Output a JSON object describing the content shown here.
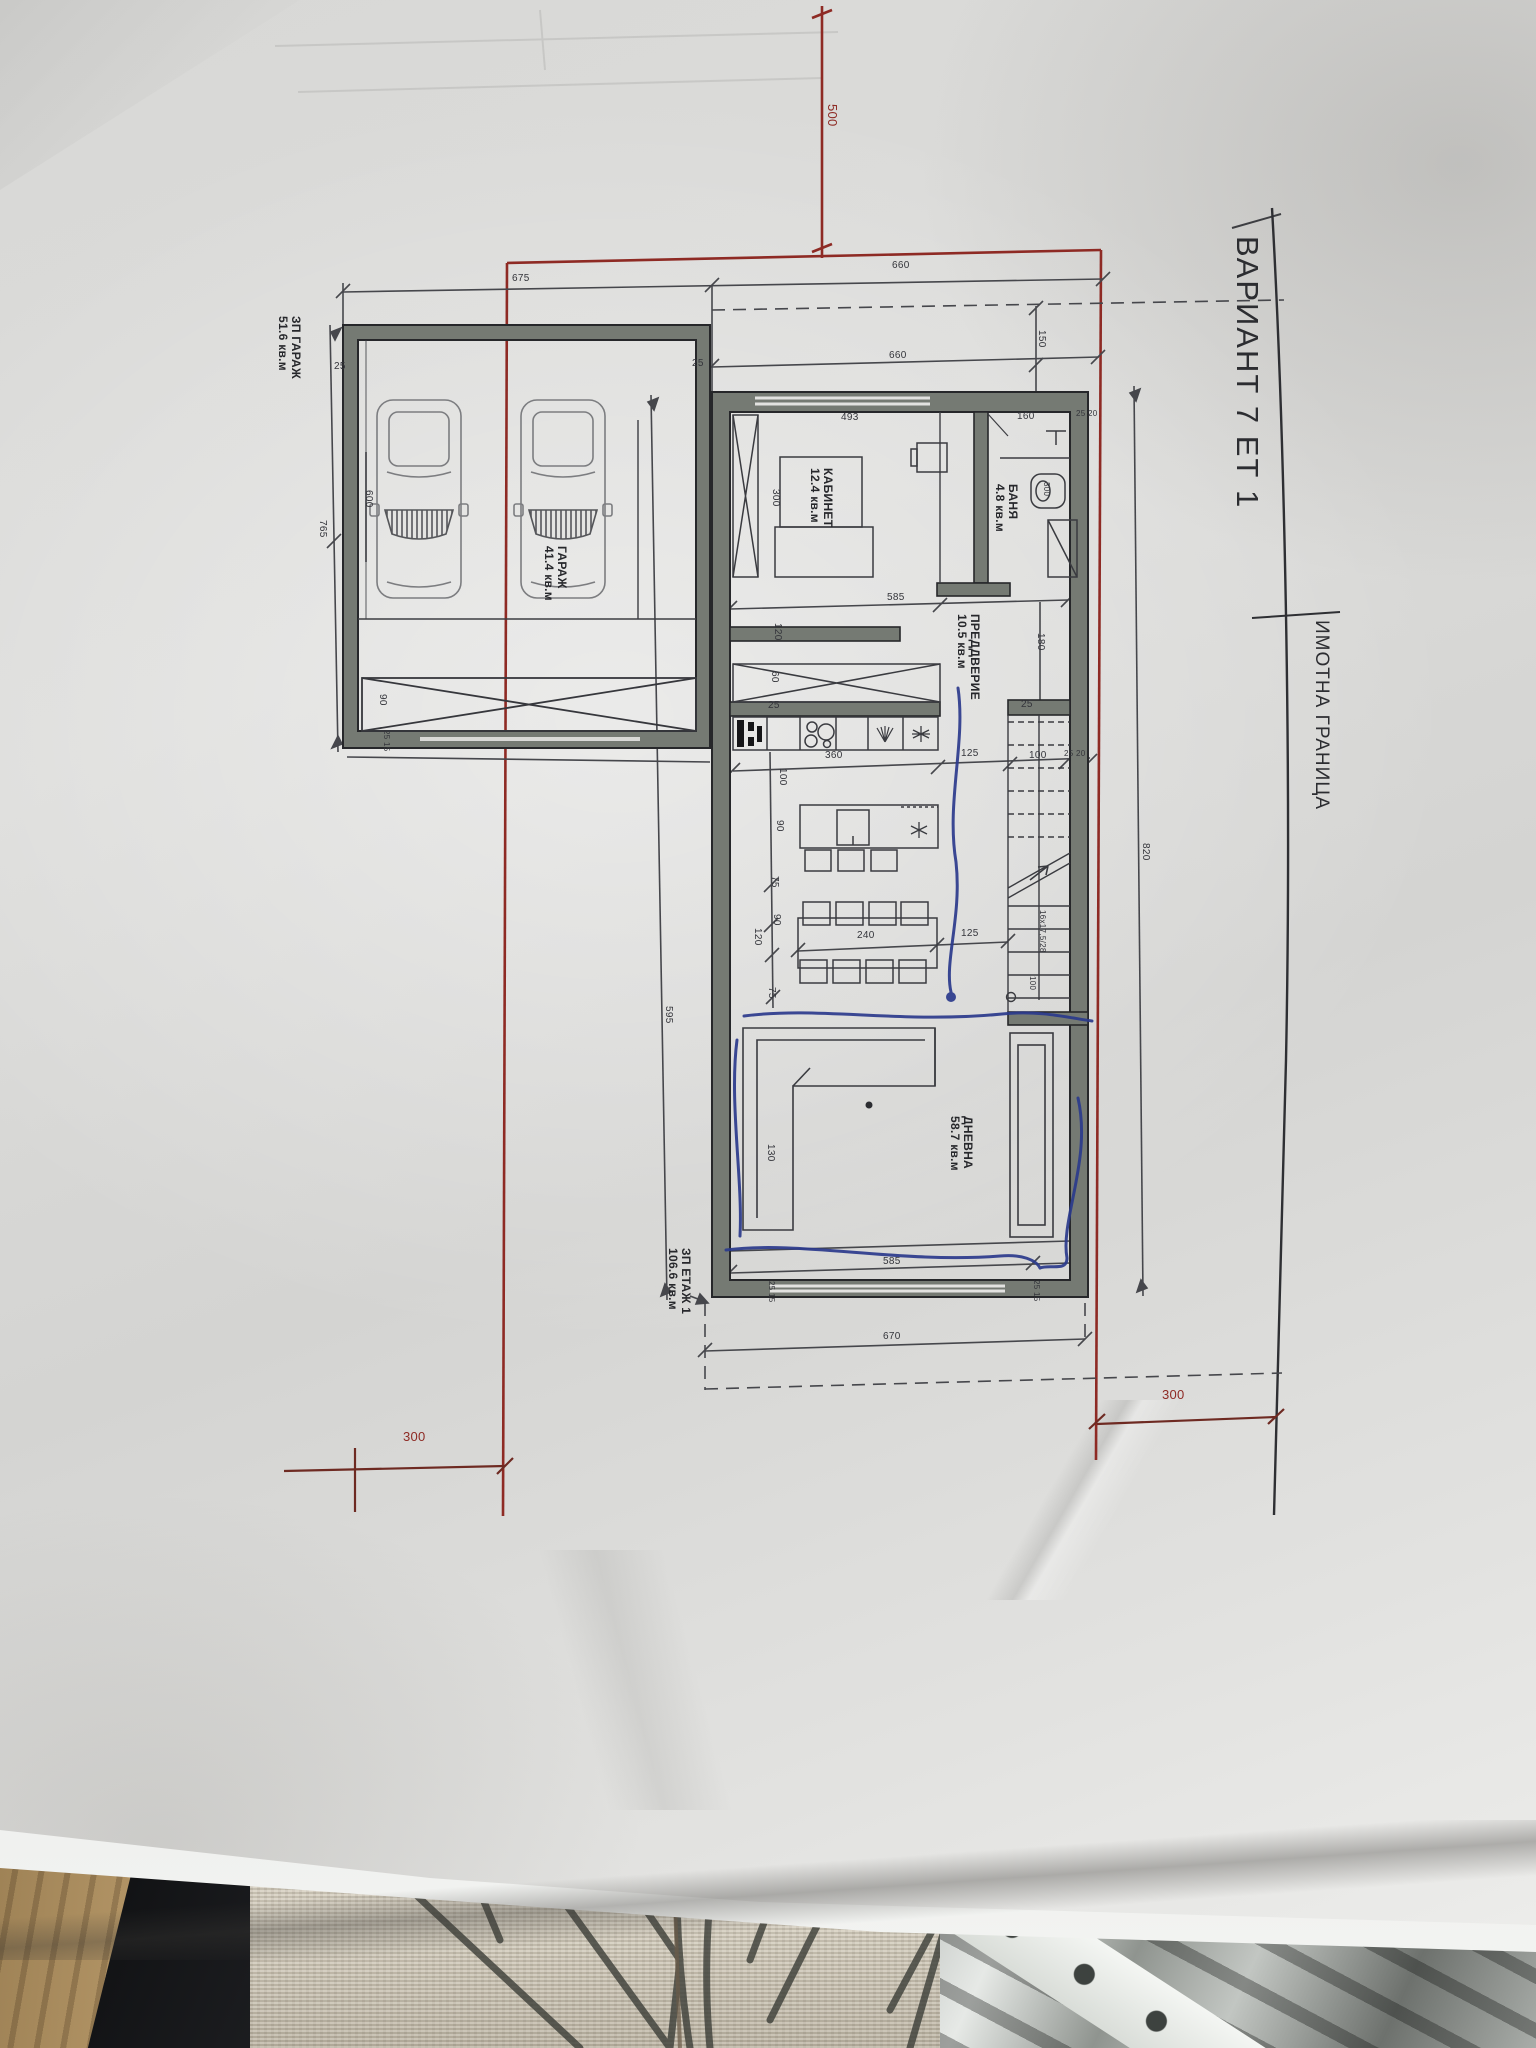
{
  "document": {
    "type": "architectural floor plan photo",
    "title": "ВАРИАНТ 7 ЕТ 1",
    "boundary_label": "ИМОТНА ГРАНИЦА",
    "stairs_note": "16x17,5/28",
    "colors": {
      "paper": "#dcdcda",
      "ink": "#34353b",
      "wall_fill": "#757a73",
      "setback_red": "#8e2a24",
      "pen_blue": "#2b3a8c"
    }
  },
  "rooms": [
    {
      "name": "КАБИНЕТ",
      "area": "12.4 кв.м",
      "label": {
        "x": 834,
        "y": 468
      }
    },
    {
      "name": "БАНЯ",
      "area": "4.8 кв.м",
      "label": {
        "x": 1019,
        "y": 484
      }
    },
    {
      "name": "ПРЕДДВЕРИЕ",
      "area": "10.5 кв.м",
      "label": {
        "x": 981,
        "y": 614
      }
    },
    {
      "name": "ДНЕВНА",
      "area": "58.7 кв.м",
      "label": {
        "x": 974,
        "y": 1116
      }
    },
    {
      "name": "ГАРАЖ",
      "area": "41.4 кв.м",
      "label": {
        "x": 568,
        "y": 546
      }
    }
  ],
  "area_summaries": [
    {
      "name": "ЗП ГАРАЖ",
      "area": "51.6 кв.м",
      "label": {
        "x": 302,
        "y": 316
      }
    },
    {
      "name": "ЗП ЕТАЖ 1",
      "area": "106.6 кв.м",
      "label": {
        "x": 692,
        "y": 1248
      }
    }
  ],
  "setbacks": [
    {
      "value": "500",
      "x": 839,
      "y": 104,
      "rot": 90,
      "cls": "red dim13"
    },
    {
      "value": "300",
      "x": 403,
      "y": 1430,
      "rot": 0,
      "cls": "red dim13"
    },
    {
      "value": "300",
      "x": 1162,
      "y": 1388,
      "rot": 0,
      "cls": "red dim13"
    }
  ],
  "dims": [
    {
      "value": "675",
      "x": 512,
      "y": 274,
      "rot": 0
    },
    {
      "value": "660",
      "x": 892,
      "y": 261,
      "rot": 0
    },
    {
      "value": "660",
      "x": 889,
      "y": 351,
      "rot": 0
    },
    {
      "value": "150",
      "x": 1046,
      "y": 330,
      "rot": 90
    },
    {
      "value": "765",
      "x": 327,
      "y": 520,
      "rot": 90
    },
    {
      "value": "600",
      "x": 373,
      "y": 490,
      "rot": 90
    },
    {
      "value": "25",
      "x": 334,
      "y": 362,
      "rot": 0
    },
    {
      "value": "25",
      "x": 692,
      "y": 359,
      "rot": 0
    },
    {
      "value": "90",
      "x": 387,
      "y": 694,
      "rot": 90
    },
    {
      "value": "25 15",
      "x": 390,
      "y": 730,
      "rot": 90,
      "small": true
    },
    {
      "value": "493",
      "x": 841,
      "y": 413,
      "rot": 0
    },
    {
      "value": "160",
      "x": 1017,
      "y": 412,
      "rot": 0
    },
    {
      "value": "25 20",
      "x": 1076,
      "y": 410,
      "rot": 0,
      "small": true
    },
    {
      "value": "300",
      "x": 780,
      "y": 489,
      "rot": 90
    },
    {
      "value": "300",
      "x": 1050,
      "y": 482,
      "rot": 90,
      "small": true
    },
    {
      "value": "585",
      "x": 887,
      "y": 593,
      "rot": 0
    },
    {
      "value": "120",
      "x": 782,
      "y": 623,
      "rot": 90
    },
    {
      "value": "180",
      "x": 1045,
      "y": 633,
      "rot": 90
    },
    {
      "value": "60",
      "x": 779,
      "y": 671,
      "rot": 90
    },
    {
      "value": "25",
      "x": 768,
      "y": 701,
      "rot": 0
    },
    {
      "value": "25",
      "x": 1021,
      "y": 700,
      "rot": 0
    },
    {
      "value": "360",
      "x": 825,
      "y": 751,
      "rot": 0
    },
    {
      "value": "125",
      "x": 961,
      "y": 749,
      "rot": 0
    },
    {
      "value": "100",
      "x": 1029,
      "y": 751,
      "rot": 0
    },
    {
      "value": "25 20",
      "x": 1064,
      "y": 750,
      "rot": 0,
      "small": true
    },
    {
      "value": "100",
      "x": 787,
      "y": 768,
      "rot": 90
    },
    {
      "value": "90",
      "x": 784,
      "y": 820,
      "rot": 90
    },
    {
      "value": "75",
      "x": 779,
      "y": 876,
      "rot": 90
    },
    {
      "value": "90",
      "x": 781,
      "y": 914,
      "rot": 90
    },
    {
      "value": "120",
      "x": 762,
      "y": 928,
      "rot": 90
    },
    {
      "value": "240",
      "x": 857,
      "y": 931,
      "rot": 0
    },
    {
      "value": "125",
      "x": 961,
      "y": 929,
      "rot": 0
    },
    {
      "value": "75",
      "x": 776,
      "y": 987,
      "rot": 90
    },
    {
      "value": "16x17,5/28",
      "x": 1046,
      "y": 910,
      "rot": 90,
      "small": true
    },
    {
      "value": "100",
      "x": 1036,
      "y": 976,
      "rot": 90,
      "small": true
    },
    {
      "value": "130",
      "x": 775,
      "y": 1144,
      "rot": 90
    },
    {
      "value": "585",
      "x": 883,
      "y": 1257,
      "rot": 0
    },
    {
      "value": "25 15",
      "x": 775,
      "y": 1281,
      "rot": 90,
      "small": true
    },
    {
      "value": "25 15",
      "x": 1040,
      "y": 1280,
      "rot": 90,
      "small": true
    },
    {
      "value": "670",
      "x": 883,
      "y": 1332,
      "rot": 0
    },
    {
      "value": "595",
      "x": 673,
      "y": 1006,
      "rot": 90
    },
    {
      "value": "820",
      "x": 1150,
      "y": 843,
      "rot": 90
    }
  ]
}
